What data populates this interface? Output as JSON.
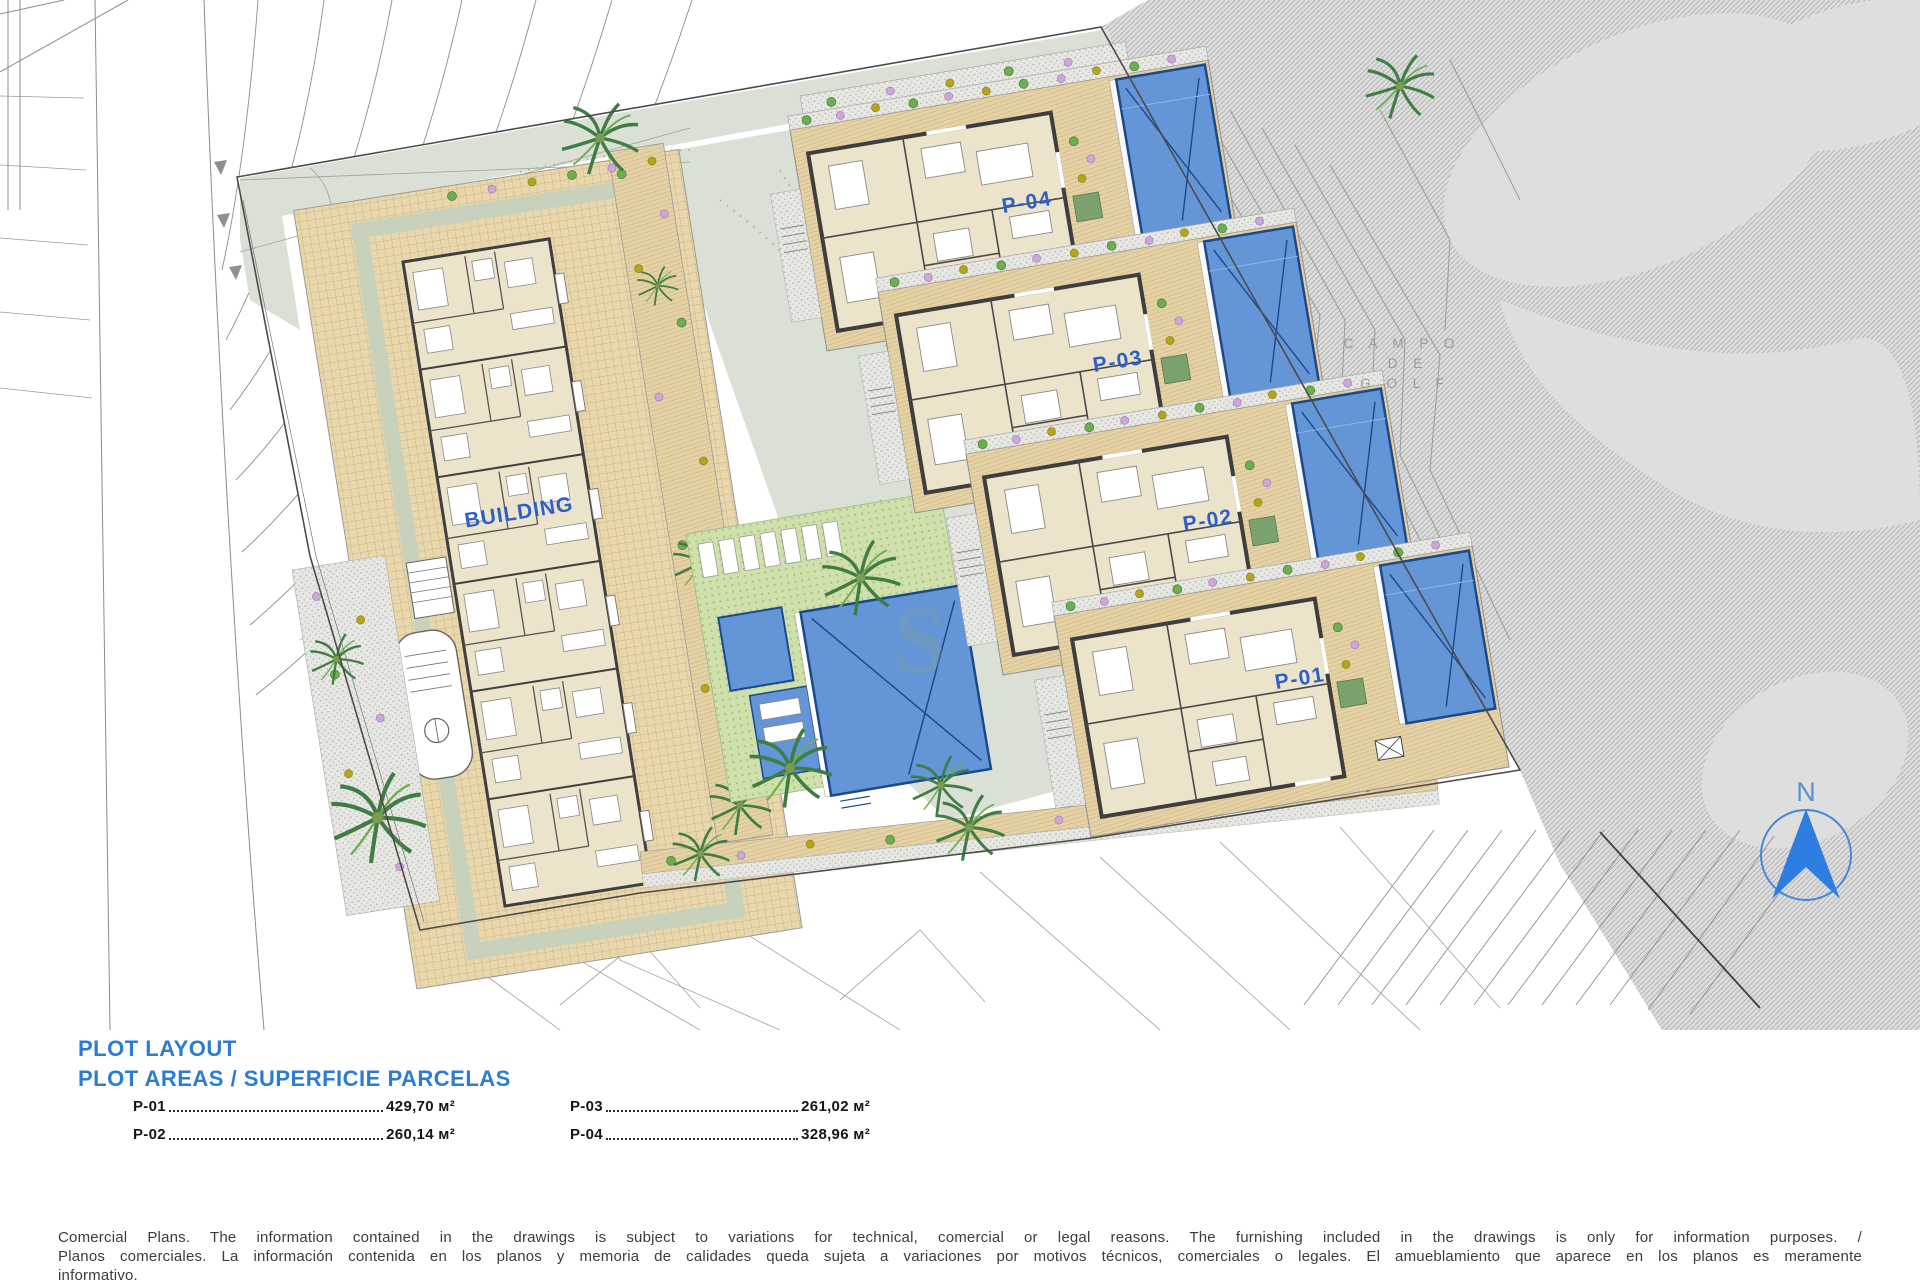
{
  "plan": {
    "building_label": "BUILDING",
    "golf_label": {
      "line1": "C A M P O",
      "line2": "D E",
      "line3": "G O L F"
    },
    "north_label": "N",
    "watermark": "S"
  },
  "plots": [
    {
      "id": "P-01",
      "area": "429,70 м²"
    },
    {
      "id": "P-02",
      "area": "260,14 м²"
    },
    {
      "id": "P-03",
      "area": "261,02 м²"
    },
    {
      "id": "P-04",
      "area": "328,96 м²"
    }
  ],
  "legend": {
    "title": "PLOT LAYOUT",
    "subtitle": "PLOT AREAS / SUPERFICIE PARCELAS"
  },
  "footer": {
    "line1": "Comercial Plans. The information contained in the drawings is subject to variations for technical, comercial or legal reasons. The furnishing included in the drawings is only for information purposes. /",
    "line2": "Planos comerciales. La información contenida en los planos y memoria de calidades queda sujeta a variaciones por motivos técnicos, comerciales o legales. El amueblamiento que aparece en los planos es meramente",
    "line3": "informativo."
  },
  "colors": {
    "label_blue": "#2e5fc9",
    "heading_blue": "#2a7cd4",
    "pool_blue": "#6495d7",
    "pool_border": "#1a4a8c",
    "terrace_tan": "#e5d2a4",
    "path_sage": "#dbe0d6",
    "golf_grey": "#dcdcdc"
  }
}
